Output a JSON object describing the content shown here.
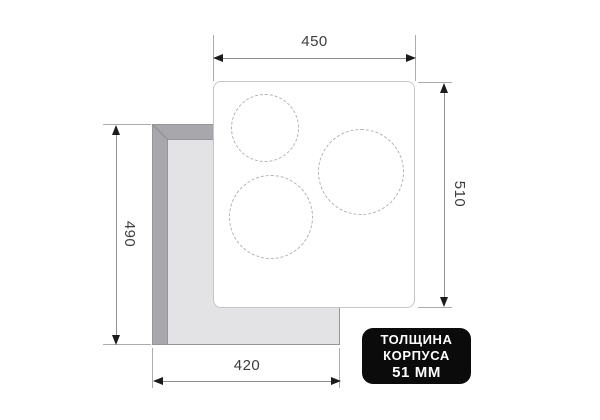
{
  "diagram": {
    "dims": {
      "top_width": "450",
      "right_height": "510",
      "left_height": "490",
      "bottom_width": "420"
    },
    "badge": {
      "line1": "ТОЛЩИНА",
      "line2": "КОРПУСА",
      "line3": "51 ММ",
      "bg_color": "#0b0b0b",
      "text_color": "#ffffff"
    },
    "colors": {
      "cutout_edge": "#a8a8ac",
      "cutout_face": "#e3e3e6",
      "panel_border": "#c6c6ca",
      "burner_dash": "#b2b2b7",
      "dim_line": "#8f8f8f",
      "dim_text": "#3d3d3d"
    },
    "burners": [
      {
        "cx": 51,
        "cy": 46,
        "r": 34
      },
      {
        "cx": 147,
        "cy": 90,
        "r": 43
      },
      {
        "cx": 57,
        "cy": 135,
        "r": 42
      }
    ]
  }
}
